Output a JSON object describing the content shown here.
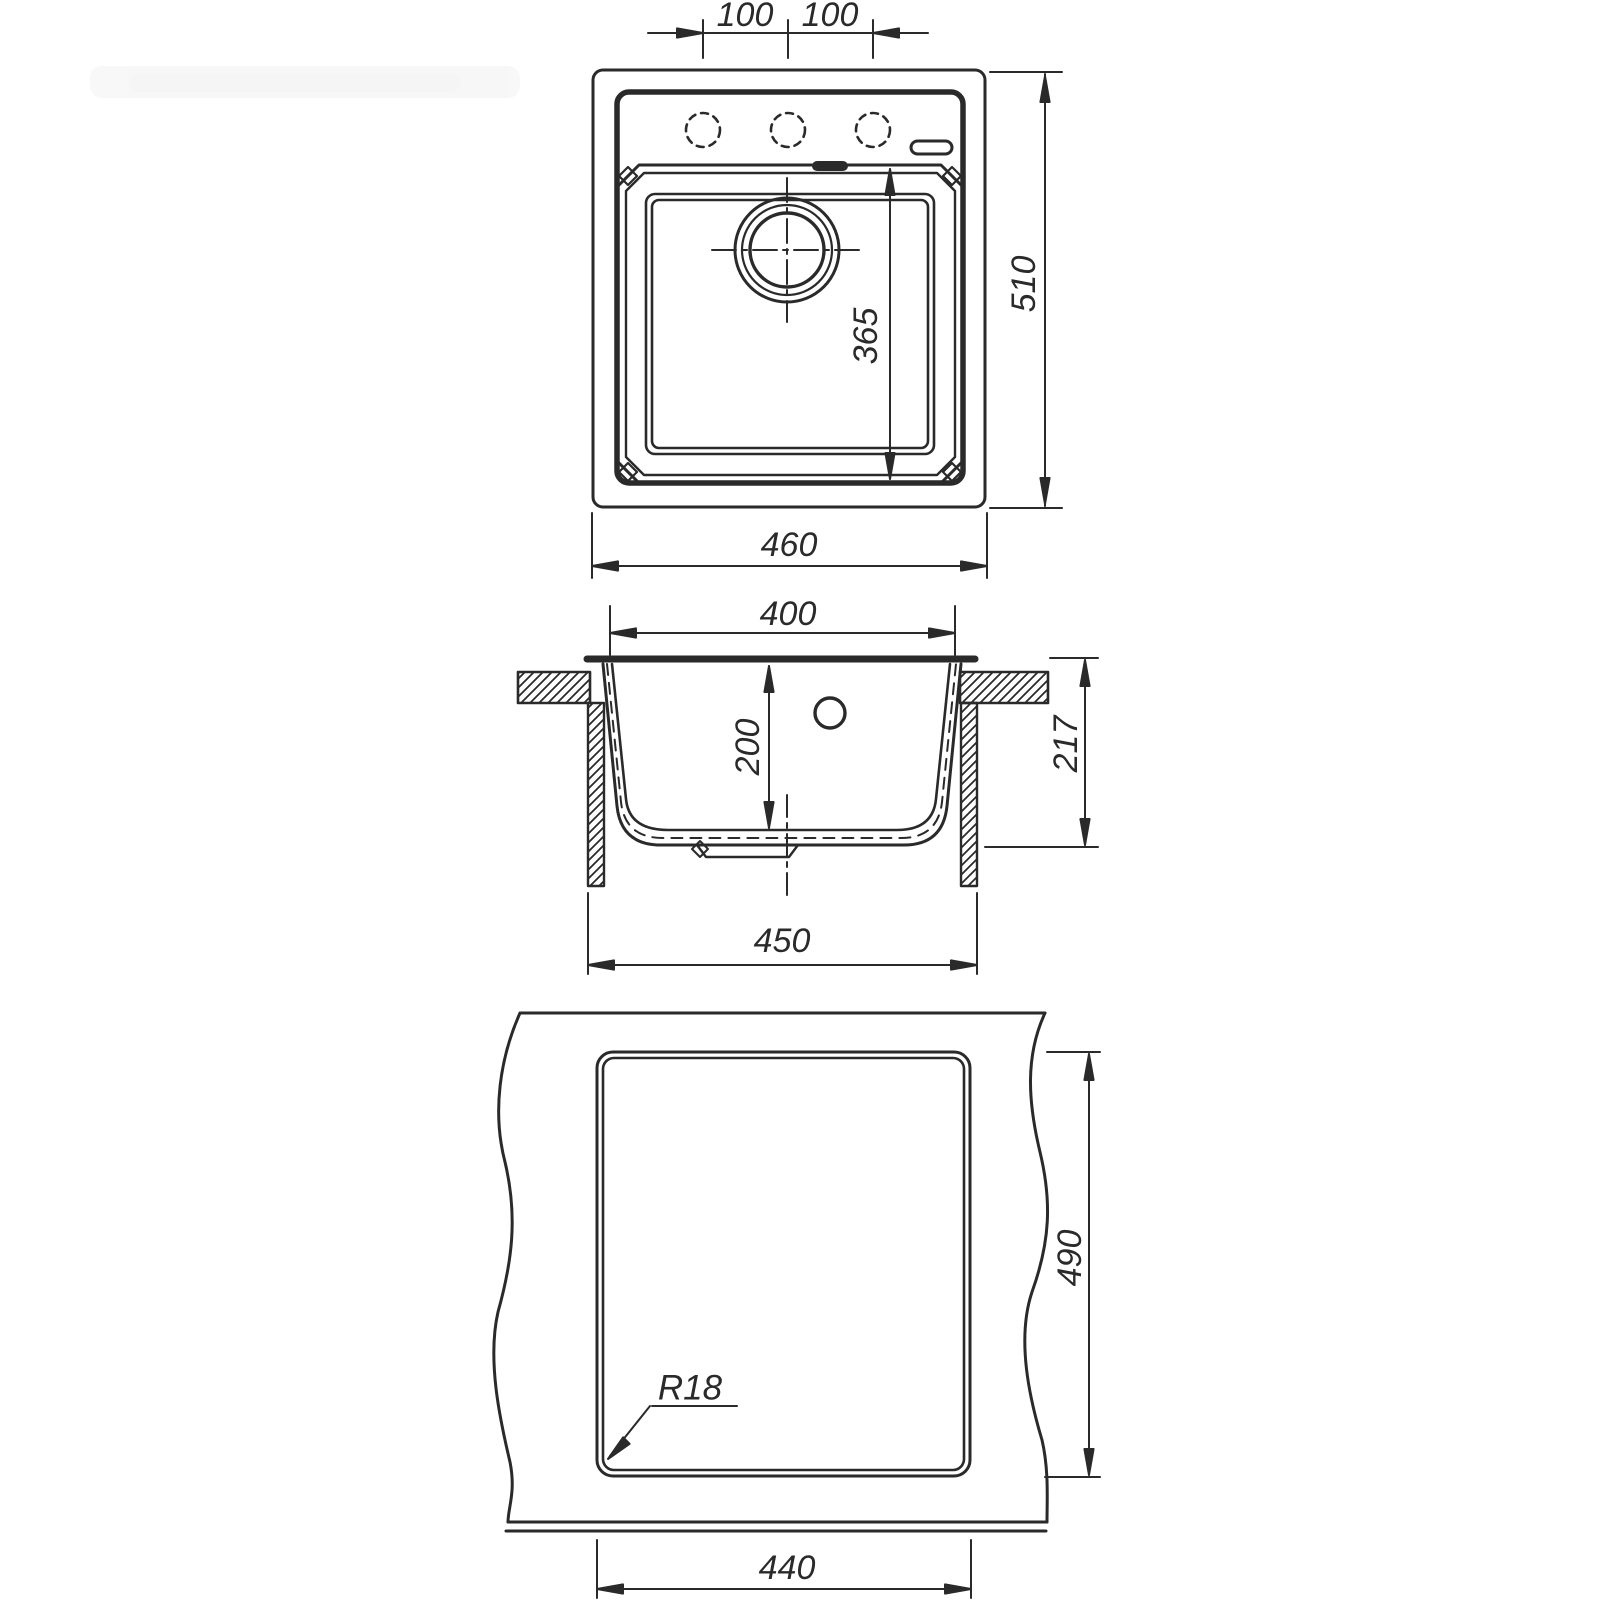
{
  "document": {
    "type": "technical-dimension-drawing",
    "subject": "kitchen sink installation drawing, three orthographic views"
  },
  "colors": {
    "line": "#2a2a2a",
    "background": "#ffffff"
  },
  "views": {
    "top_view": {
      "name": "top-view",
      "dims": {
        "hole_pitch_left": "100",
        "hole_pitch_right": "100",
        "overall_depth": "510",
        "bowl_length": "365",
        "overall_width": "460"
      }
    },
    "section_view": {
      "name": "section-view",
      "dims": {
        "bowl_top_width": "400",
        "bowl_depth": "200",
        "overall_height": "217",
        "clamp_span": "450"
      }
    },
    "cutout_view": {
      "name": "countertop-cutout-view",
      "dims": {
        "cutout_height": "490",
        "cutout_width": "440",
        "corner_radius": "R18"
      }
    }
  }
}
